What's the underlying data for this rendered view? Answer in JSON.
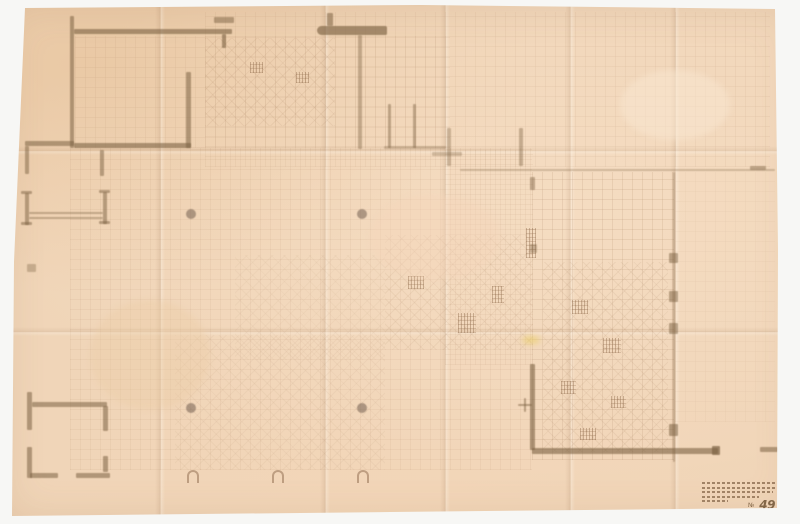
{
  "artifact": {
    "type": "scanned architectural drawing",
    "description": "Faint pencil floor plan on aged, folded tracing paper; photographed on a white backdrop"
  },
  "colors": {
    "backdrop": "#f7f7f5",
    "paper": "#f0d5b8",
    "pencil": "#7d6344",
    "pencil_faint": "#9b7352",
    "highlight_yellow": "#e9cd5f"
  },
  "title_block": {
    "number_prefix": "№",
    "number": "49",
    "line_widths": [
      74,
      73,
      71,
      57,
      26
    ]
  },
  "plan": {
    "creases_v": [
      160,
      325,
      445,
      570,
      675
    ],
    "creases_h": [
      150,
      331
    ],
    "grid_patches": [
      [
        205,
        12,
        565,
        155,
        0.5
      ],
      [
        75,
        36,
        375,
        112,
        0.5
      ],
      [
        70,
        148,
        462,
        322,
        0.55
      ],
      [
        445,
        150,
        88,
        215,
        0.5
      ],
      [
        532,
        172,
        142,
        288,
        0.95
      ],
      [
        675,
        172,
        100,
        250,
        0.3
      ]
    ],
    "diag_patches": [
      [
        205,
        38,
        130,
        88,
        0.8
      ],
      [
        385,
        235,
        148,
        115,
        0.7
      ],
      [
        543,
        262,
        125,
        190,
        0.75
      ],
      [
        175,
        335,
        210,
        135,
        0.5
      ],
      [
        235,
        255,
        150,
        105,
        0.4
      ]
    ],
    "tiles": [
      [
        408,
        276,
        16,
        13
      ],
      [
        458,
        313,
        18,
        20
      ],
      [
        492,
        286,
        12,
        17
      ],
      [
        526,
        228,
        10,
        30
      ],
      [
        572,
        300,
        16,
        14
      ],
      [
        603,
        338,
        18,
        15
      ],
      [
        561,
        381,
        15,
        13
      ],
      [
        611,
        396,
        15,
        12
      ],
      [
        580,
        428,
        16,
        12
      ],
      [
        250,
        62,
        13,
        11
      ],
      [
        296,
        72,
        13,
        11
      ]
    ],
    "walls": [
      [
        70,
        16,
        4,
        132,
        0.55
      ],
      [
        74,
        29,
        158,
        5,
        0.6
      ],
      [
        222,
        34,
        4,
        14,
        0.6
      ],
      [
        214,
        17,
        20,
        6,
        0.5
      ],
      [
        186,
        72,
        5,
        76,
        0.55
      ],
      [
        74,
        143,
        117,
        5,
        0.6
      ],
      [
        25,
        141,
        49,
        5,
        0.55
      ],
      [
        25,
        146,
        4,
        28,
        0.5
      ],
      [
        100,
        150,
        4,
        26,
        0.5
      ],
      [
        317,
        26,
        70,
        9,
        0.65,
        "5px 2px 2px 5px"
      ],
      [
        327,
        13,
        6,
        13,
        0.55
      ],
      [
        358,
        35,
        4,
        114,
        0.4
      ],
      [
        388,
        104,
        3,
        44,
        0.45
      ],
      [
        413,
        104,
        3,
        44,
        0.45
      ],
      [
        384,
        146,
        62,
        3,
        0.3
      ],
      [
        25,
        193,
        4,
        32,
        0.5
      ],
      [
        21,
        191,
        11,
        3,
        0.5
      ],
      [
        21,
        222,
        11,
        3,
        0.5
      ],
      [
        103,
        192,
        4,
        32,
        0.5
      ],
      [
        99,
        190,
        11,
        3,
        0.5
      ],
      [
        99,
        221,
        11,
        3,
        0.5
      ],
      [
        29,
        212,
        74,
        2,
        0.4
      ],
      [
        29,
        217,
        74,
        2,
        0.4
      ],
      [
        27,
        264,
        9,
        8,
        0.35
      ],
      [
        460,
        169,
        315,
        2,
        0.3
      ],
      [
        750,
        166,
        16,
        4,
        0.45
      ],
      [
        673,
        172,
        2,
        290,
        0.35
      ],
      [
        530,
        177,
        5,
        13,
        0.45
      ],
      [
        530,
        244,
        7,
        9,
        0.4
      ],
      [
        669,
        253,
        9,
        10,
        0.5
      ],
      [
        669,
        291,
        9,
        11,
        0.5
      ],
      [
        669,
        323,
        9,
        11,
        0.5
      ],
      [
        669,
        424,
        9,
        12,
        0.55
      ],
      [
        447,
        128,
        4,
        38,
        0.35
      ],
      [
        432,
        152,
        30,
        4,
        0.3
      ],
      [
        519,
        128,
        4,
        38,
        0.4
      ],
      [
        530,
        364,
        5,
        86,
        0.6
      ],
      [
        532,
        448,
        186,
        6,
        0.6
      ],
      [
        712,
        446,
        8,
        9,
        0.7
      ],
      [
        760,
        447,
        18,
        5,
        0.55
      ],
      [
        518,
        404,
        14,
        2,
        0.5
      ],
      [
        524,
        398,
        2,
        14,
        0.5
      ],
      [
        27,
        392,
        5,
        38,
        0.55
      ],
      [
        27,
        447,
        5,
        31,
        0.55
      ],
      [
        32,
        402,
        75,
        5,
        0.55
      ],
      [
        103,
        406,
        5,
        25,
        0.55
      ],
      [
        103,
        456,
        5,
        16,
        0.55
      ],
      [
        30,
        473,
        28,
        5,
        0.55
      ],
      [
        76,
        473,
        34,
        5,
        0.55
      ]
    ],
    "columns": [
      [
        191,
        214
      ],
      [
        362,
        214
      ],
      [
        191,
        408
      ],
      [
        362,
        408
      ]
    ],
    "arches": [
      [
        187,
        470
      ],
      [
        272,
        470
      ],
      [
        357,
        470
      ]
    ],
    "stains": [
      [
        522,
        336,
        18,
        8,
        "rgba(233,205,95,0.55)"
      ],
      [
        620,
        70,
        110,
        70,
        "rgba(250,232,210,0.5)"
      ],
      [
        370,
        195,
        130,
        85,
        "rgba(246,212,186,0.4)"
      ],
      [
        90,
        300,
        120,
        110,
        "rgba(236,202,164,0.35)"
      ]
    ]
  }
}
